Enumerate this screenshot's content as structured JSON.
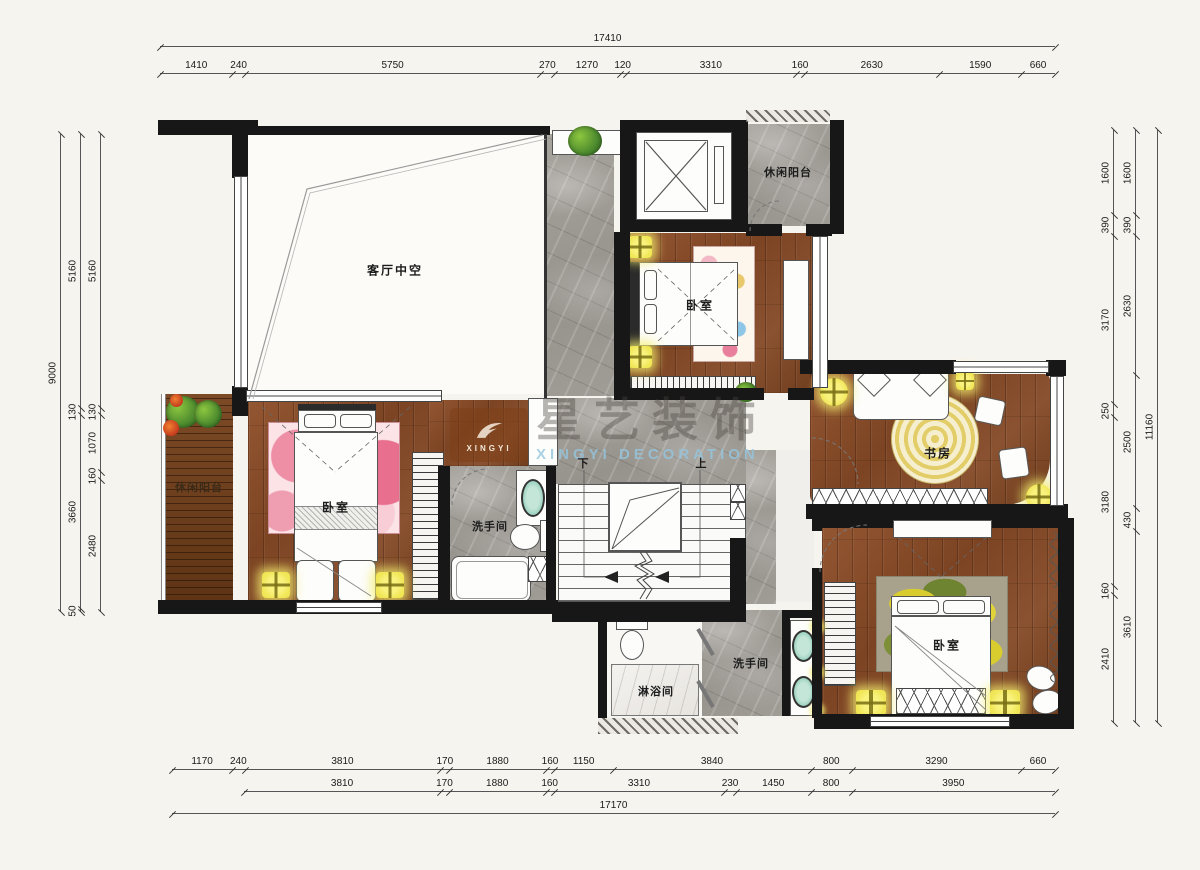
{
  "rooms": {
    "living_void": "客厅中空",
    "balcony_top": "休闲阳台",
    "bedroom_top": "卧室",
    "study": "书房",
    "balcony_left": "休闲阳台",
    "bedroom_left": "卧室",
    "bathroom_left": "洗手间",
    "bathroom_bottom": "洗手间",
    "shower": "淋浴间",
    "bedroom_bottom": "卧室",
    "stairs_down": "下",
    "stairs_up": "上"
  },
  "watermark": {
    "logo_text": "XINGYI",
    "brand_cn": "星艺装饰",
    "brand_en": "XINGYI DECORATION"
  },
  "dims": {
    "top": {
      "total": "17410",
      "chain": [
        "1410",
        "240",
        "5750",
        "270",
        "1270",
        "120",
        "3310",
        "160",
        "2630",
        "1590",
        "660"
      ]
    },
    "bottom": {
      "row1": [
        "1170",
        "240",
        "3810",
        "170",
        "1880",
        "160",
        "1150",
        "3840",
        "800",
        "3290",
        "660"
      ],
      "row2": [
        "3810",
        "170",
        "1880",
        "160",
        "3310",
        "230",
        "1450",
        "800",
        "3950"
      ],
      "total": "17170"
    },
    "left": {
      "total": "9000",
      "chain_a": [
        "5160",
        "130",
        "3660",
        "50"
      ],
      "chain_b": [
        "5160",
        "130",
        "1070",
        "160",
        "2480"
      ]
    },
    "right": {
      "inner": [
        "1600",
        "390",
        "3170",
        "250",
        "3180",
        "160",
        "2410"
      ],
      "mid": [
        "1600",
        "390",
        "2630",
        "2500",
        "430",
        "3610"
      ],
      "total": "11160"
    }
  },
  "colors": {
    "wall": "#171717",
    "wood": "#8a5230",
    "marble": "#9d9993",
    "accent_light": "#f2e96b",
    "sink": "#8fccba",
    "watermark_brown": "#7d4018",
    "watermark_blue": "#94c6de",
    "background": "#f6f4ef"
  }
}
